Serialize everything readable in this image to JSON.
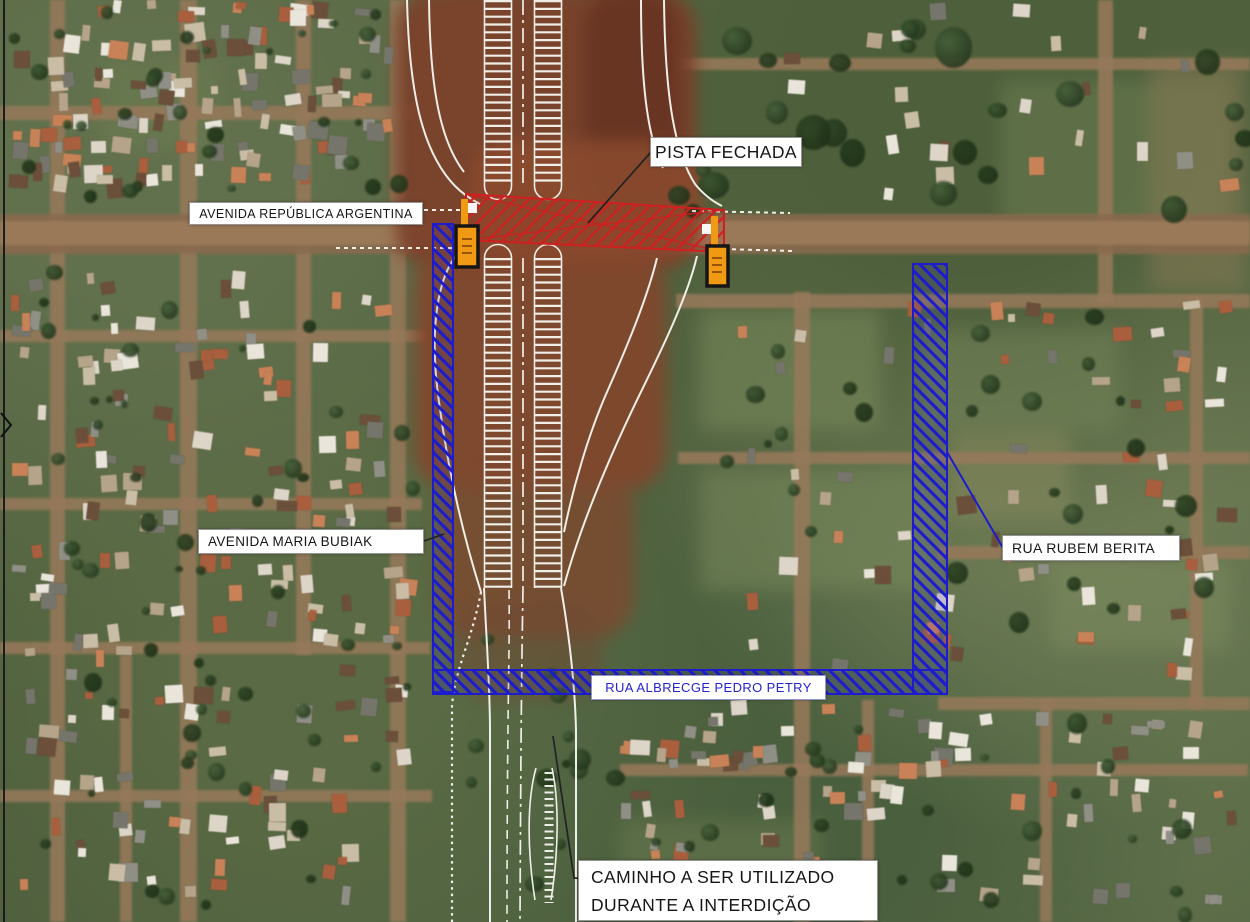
{
  "plan": {
    "labels": {
      "closed_lane": "PISTA FECHADA",
      "avenue_top": "AVENIDA REPÚBLICA ARGENTINA",
      "avenue_left": "AVENIDA MARIA BUBIAK",
      "street_right": "RUA RUBEM BERITA",
      "street_bottom": "RUA ALBRECGE PEDRO PETRY",
      "detour_note_line1": "CAMINHO A SER UTILIZADO",
      "detour_note_line2": "DURANTE A INTERDIÇÃO"
    },
    "colors": {
      "closed_lane_hatch": "#cf1f1f",
      "detour_hatch": "#1c1ccd",
      "sign_marker_fill": "#f09a14",
      "sign_marker_border": "#151515",
      "road_line": "#f7f7f1",
      "label_background": "#ffffff",
      "label_text": "#161616",
      "street_bottom_text": "#2323cf",
      "leader_line": "#222222"
    }
  }
}
